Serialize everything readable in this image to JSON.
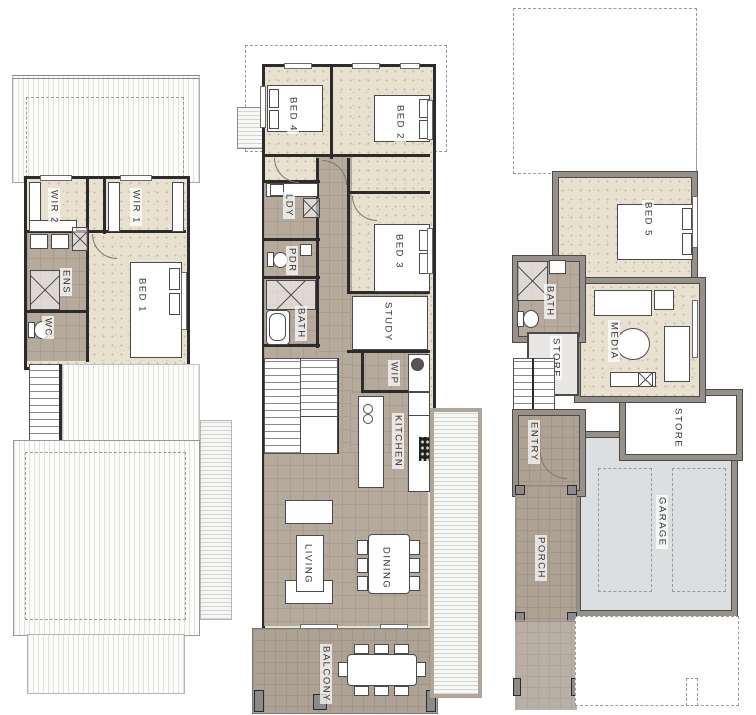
{
  "sheet": {
    "type": "architectural-floor-plans",
    "plan_count": 3
  },
  "palette": {
    "carpet": "#e9e1d0",
    "interior_tile": "#b6aa9d",
    "outdoor_tile": "#aea295",
    "wall_dark": "#2b2b2b",
    "wall_grey": "#96908a",
    "garage_floor": "#dcdedf",
    "roof_white": "#fcfcfb",
    "dashed_line": "#9a9a9a"
  },
  "plans": {
    "upper": {
      "rooms": {
        "wir2": "WIR 2",
        "wir1": "WIR 1",
        "ens": "ENS",
        "wc": "WC",
        "bed1": "BED 1"
      }
    },
    "main": {
      "rooms": {
        "bed4": "BED 4",
        "bed2": "BED 2",
        "ldy": "LDY",
        "pdr": "PDR",
        "bath": "BATH",
        "bed3": "BED 3",
        "study": "STUDY",
        "wip": "WIP",
        "kitchen": "KITCHEN",
        "living": "LIVING",
        "dining": "DINING",
        "balcony": "BALCONY"
      }
    },
    "ground": {
      "rooms": {
        "bed5": "BED 5",
        "bath": "BATH",
        "store_stairs": "STORE",
        "media": "MEDIA",
        "entry": "ENTRY",
        "store_garage": "STORE",
        "garage": "GARAGE",
        "porch": "PORCH"
      }
    }
  }
}
